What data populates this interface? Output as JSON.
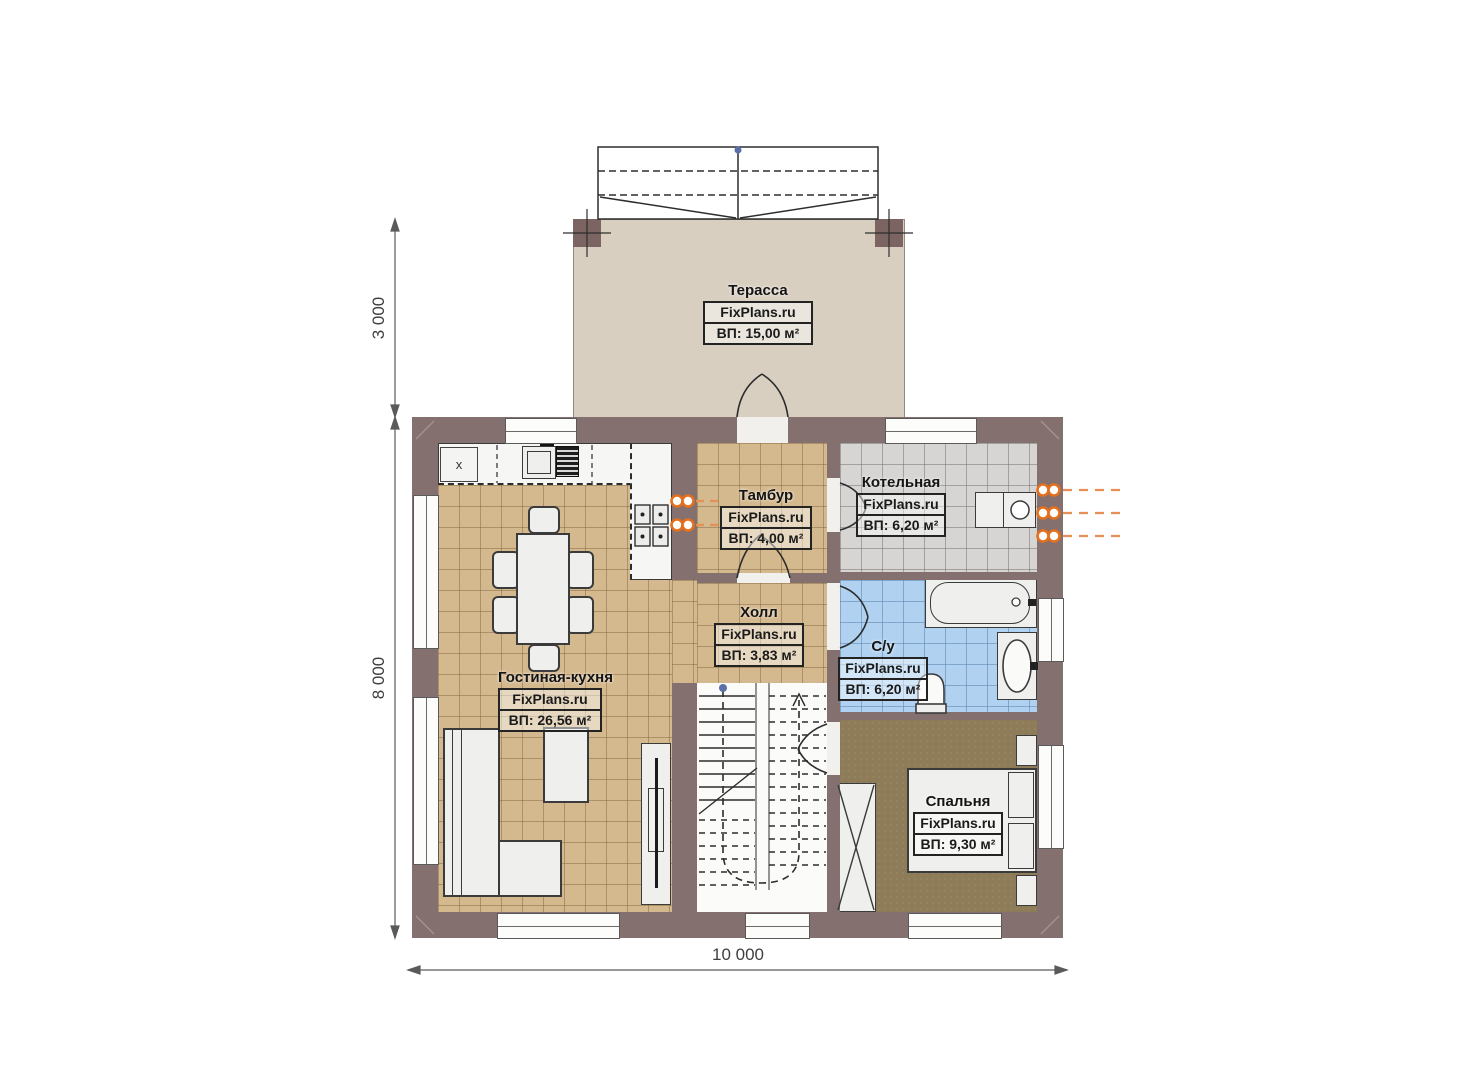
{
  "watermark": "FixPlans.ru",
  "rooms": {
    "terrace": {
      "name": "Терасса",
      "area": "ВП: 15,00 м²"
    },
    "tambour": {
      "name": "Тамбур",
      "area": "ВП: 4,00 м²"
    },
    "boiler": {
      "name": "Котельная",
      "area": "ВП: 6,20 м²"
    },
    "hall": {
      "name": "Холл",
      "area": "ВП: 3,83 м²"
    },
    "bathroom": {
      "name": "С/у",
      "area": "ВП: 6,20 м²"
    },
    "living": {
      "name": "Гостиная-кухня",
      "area": "ВП: 26,56 м²"
    },
    "bedroom": {
      "name": "Спальня",
      "area": "ВП: 9,30 м²"
    }
  },
  "dimensions": {
    "terrace_depth": "3 000",
    "house_depth": "8 000",
    "house_width": "10 000"
  },
  "markers": {
    "kitchen_x": "x"
  },
  "colors": {
    "wall": "#84706f",
    "floor_wood": "#d4b88e",
    "floor_boiler": "#d6d5d3",
    "floor_bath": "#b0d2f0",
    "floor_bedroom": "#8e7c59",
    "terrace": "#d9cfc1",
    "utility_accent": "#e4701e"
  }
}
